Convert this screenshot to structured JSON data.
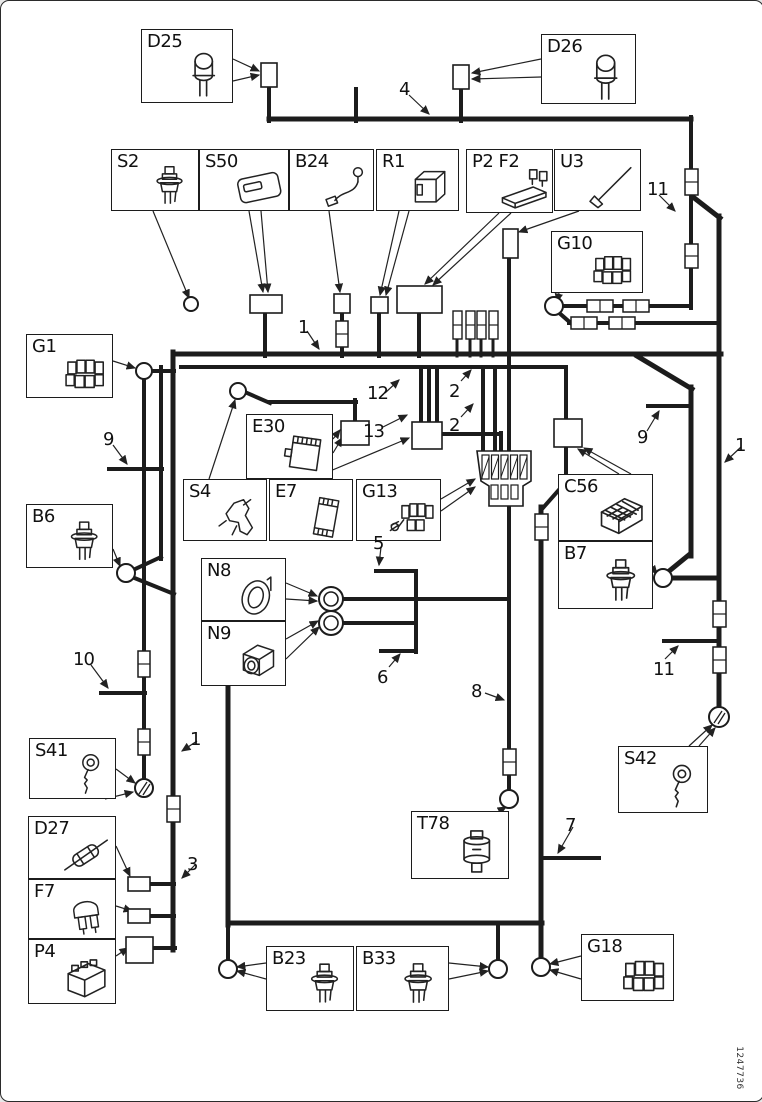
{
  "title": "Wiring harness diagram",
  "part_number": "1247736",
  "colors": {
    "line": "#1c1c1c",
    "background": "#ffffff"
  },
  "components": [
    {
      "id": "D25",
      "label": "D25",
      "icon": "bulb",
      "box": [
        140,
        28,
        92,
        74
      ]
    },
    {
      "id": "D26",
      "label": "D26",
      "icon": "bulb",
      "box": [
        540,
        33,
        95,
        70
      ]
    },
    {
      "id": "S2",
      "label": "S2",
      "icon": "sensor",
      "box": [
        110,
        148,
        88,
        62
      ]
    },
    {
      "id": "S50",
      "label": "S50",
      "icon": "module",
      "box": [
        198,
        148,
        90,
        62
      ]
    },
    {
      "id": "B24",
      "label": "B24",
      "icon": "cable",
      "box": [
        288,
        148,
        85,
        62
      ]
    },
    {
      "id": "R1",
      "label": "R1",
      "icon": "relay",
      "box": [
        375,
        148,
        83,
        62
      ]
    },
    {
      "id": "P2F2",
      "label": "P2 F2",
      "icon": "fusebox",
      "box": [
        465,
        148,
        87,
        64
      ]
    },
    {
      "id": "U3",
      "label": "U3",
      "icon": "antenna",
      "box": [
        553,
        148,
        87,
        62
      ]
    },
    {
      "id": "G10",
      "label": "G10",
      "icon": "connblock",
      "box": [
        550,
        230,
        92,
        62
      ]
    },
    {
      "id": "G1",
      "label": "G1",
      "icon": "connblock",
      "box": [
        25,
        333,
        87,
        64
      ]
    },
    {
      "id": "E30",
      "label": "E30",
      "icon": "ecu",
      "box": [
        245,
        413,
        87,
        65
      ]
    },
    {
      "id": "S4",
      "label": "S4",
      "icon": "switchmech",
      "box": [
        182,
        478,
        84,
        62
      ]
    },
    {
      "id": "E7",
      "label": "E7",
      "icon": "ecuplate",
      "box": [
        268,
        478,
        84,
        62
      ]
    },
    {
      "id": "G13",
      "label": "G13",
      "icon": "connwires",
      "box": [
        355,
        478,
        85,
        62
      ]
    },
    {
      "id": "C56",
      "label": "C56",
      "icon": "cage",
      "box": [
        557,
        473,
        95,
        67
      ]
    },
    {
      "id": "B7",
      "label": "B7",
      "icon": "sensor",
      "box": [
        557,
        540,
        95,
        68
      ]
    },
    {
      "id": "B6",
      "label": "B6",
      "icon": "sensor",
      "box": [
        25,
        503,
        87,
        64
      ]
    },
    {
      "id": "N8",
      "label": "N8",
      "icon": "ring",
      "box": [
        200,
        557,
        85,
        63
      ]
    },
    {
      "id": "N9",
      "label": "N9",
      "icon": "solenoid",
      "box": [
        200,
        620,
        85,
        65
      ]
    },
    {
      "id": "S41",
      "label": "S41",
      "icon": "key",
      "box": [
        28,
        737,
        87,
        61
      ]
    },
    {
      "id": "S42",
      "label": "S42",
      "icon": "key",
      "box": [
        617,
        745,
        90,
        67
      ]
    },
    {
      "id": "D27",
      "label": "D27",
      "icon": "inlinefuse",
      "box": [
        27,
        815,
        88,
        63
      ]
    },
    {
      "id": "F7",
      "label": "F7",
      "icon": "bladefuse",
      "box": [
        27,
        878,
        88,
        60
      ]
    },
    {
      "id": "P4",
      "label": "P4",
      "icon": "battery",
      "box": [
        27,
        938,
        88,
        65
      ]
    },
    {
      "id": "T78",
      "label": "T78",
      "icon": "cylsensor",
      "box": [
        410,
        810,
        98,
        68
      ]
    },
    {
      "id": "B23",
      "label": "B23",
      "icon": "sensor",
      "box": [
        265,
        945,
        88,
        65
      ]
    },
    {
      "id": "B33",
      "label": "B33",
      "icon": "sensor",
      "box": [
        355,
        945,
        93,
        65
      ]
    },
    {
      "id": "G18",
      "label": "G18",
      "icon": "connblock",
      "box": [
        580,
        933,
        93,
        67
      ]
    }
  ],
  "wire_labels": [
    {
      "text": "4",
      "x": 398,
      "y": 78
    },
    {
      "text": "11",
      "x": 646,
      "y": 178
    },
    {
      "text": "1",
      "x": 297,
      "y": 316
    },
    {
      "text": "12",
      "x": 366,
      "y": 382
    },
    {
      "text": "13",
      "x": 362,
      "y": 420
    },
    {
      "text": "2",
      "x": 448,
      "y": 380
    },
    {
      "text": "2",
      "x": 448,
      "y": 414
    },
    {
      "text": "9",
      "x": 102,
      "y": 428
    },
    {
      "text": "9",
      "x": 636,
      "y": 426
    },
    {
      "text": "1",
      "x": 734,
      "y": 434
    },
    {
      "text": "10",
      "x": 72,
      "y": 648
    },
    {
      "text": "1",
      "x": 189,
      "y": 728
    },
    {
      "text": "5",
      "x": 372,
      "y": 532
    },
    {
      "text": "6",
      "x": 376,
      "y": 666
    },
    {
      "text": "8",
      "x": 470,
      "y": 680
    },
    {
      "text": "11",
      "x": 652,
      "y": 658
    },
    {
      "text": "3",
      "x": 186,
      "y": 853
    },
    {
      "text": "7",
      "x": 564,
      "y": 814
    }
  ],
  "figure": {
    "wires": [
      [
        268,
        118,
        690,
        118,
        5
      ],
      [
        268,
        84,
        268,
        120,
        4
      ],
      [
        355,
        88,
        355,
        120,
        4
      ],
      [
        460,
        86,
        460,
        120,
        4
      ],
      [
        690,
        116,
        690,
        170,
        4
      ],
      [
        690,
        192,
        690,
        307,
        4
      ],
      [
        692,
        196,
        719,
        217,
        5
      ],
      [
        718,
        215,
        718,
        712,
        5
      ],
      [
        553,
        305,
        688,
        305,
        4
      ],
      [
        556,
        310,
        572,
        324,
        4
      ],
      [
        568,
        322,
        718,
        322,
        4
      ],
      [
        636,
        355,
        691,
        388,
        5
      ],
      [
        690,
        386,
        690,
        555,
        5
      ],
      [
        647,
        405,
        690,
        405,
        4
      ],
      [
        689,
        553,
        667,
        571,
        5
      ],
      [
        669,
        577,
        718,
        577,
        5
      ],
      [
        172,
        353,
        720,
        353,
        5
      ],
      [
        180,
        366,
        565,
        366,
        4
      ],
      [
        172,
        351,
        172,
        949,
        5
      ],
      [
        160,
        366,
        160,
        558,
        4
      ],
      [
        160,
        556,
        130,
        570,
        4
      ],
      [
        131,
        576,
        173,
        593,
        4
      ],
      [
        108,
        468,
        161,
        468,
        4
      ],
      [
        143,
        376,
        143,
        780,
        4
      ],
      [
        100,
        692,
        144,
        692,
        4
      ],
      [
        150,
        370,
        173,
        370,
        4
      ],
      [
        264,
        312,
        264,
        355,
        4
      ],
      [
        341,
        312,
        341,
        355,
        4
      ],
      [
        378,
        312,
        378,
        355,
        4
      ],
      [
        418,
        312,
        418,
        355,
        4
      ],
      [
        456,
        336,
        456,
        355,
        3
      ],
      [
        469,
        336,
        469,
        355,
        3
      ],
      [
        480,
        336,
        480,
        355,
        3
      ],
      [
        492,
        336,
        492,
        355,
        3
      ],
      [
        508,
        255,
        508,
        792,
        4
      ],
      [
        246,
        392,
        269,
        402,
        4
      ],
      [
        268,
        401,
        355,
        401,
        4
      ],
      [
        354,
        399,
        354,
        421,
        4
      ],
      [
        420,
        366,
        420,
        422,
        4
      ],
      [
        428,
        366,
        428,
        422,
        4
      ],
      [
        436,
        366,
        436,
        422,
        4
      ],
      [
        441,
        433,
        500,
        433,
        4
      ],
      [
        500,
        432,
        500,
        452,
        4
      ],
      [
        482,
        366,
        482,
        452,
        4
      ],
      [
        494,
        366,
        494,
        452,
        4
      ],
      [
        565,
        366,
        565,
        419,
        4
      ],
      [
        565,
        445,
        565,
        483,
        4
      ],
      [
        564,
        482,
        541,
        508,
        4
      ],
      [
        540,
        506,
        540,
        958,
        5
      ],
      [
        543,
        857,
        598,
        857,
        4
      ],
      [
        227,
        922,
        541,
        922,
        5
      ],
      [
        227,
        650,
        227,
        924,
        5
      ],
      [
        227,
        922,
        227,
        960,
        4
      ],
      [
        497,
        922,
        497,
        960,
        4
      ],
      [
        342,
        598,
        508,
        598,
        4
      ],
      [
        342,
        622,
        415,
        622,
        4
      ],
      [
        415,
        570,
        415,
        651,
        4
      ],
      [
        375,
        570,
        415,
        570,
        4
      ],
      [
        380,
        650,
        415,
        650,
        4
      ],
      [
        663,
        640,
        718,
        640,
        4
      ],
      [
        149,
        883,
        173,
        883,
        4
      ],
      [
        149,
        915,
        173,
        915,
        4
      ],
      [
        152,
        947,
        174,
        947,
        4
      ]
    ],
    "leaders": [
      [
        232,
        58,
        258,
        70
      ],
      [
        232,
        80,
        258,
        74
      ],
      [
        540,
        58,
        471,
        72
      ],
      [
        540,
        76,
        471,
        78
      ],
      [
        152,
        210,
        188,
        297
      ],
      [
        248,
        210,
        262,
        291
      ],
      [
        260,
        210,
        267,
        291
      ],
      [
        328,
        210,
        339,
        291
      ],
      [
        398,
        210,
        379,
        294
      ],
      [
        408,
        210,
        385,
        294
      ],
      [
        498,
        212,
        424,
        283
      ],
      [
        510,
        212,
        432,
        284
      ],
      [
        578,
        210,
        518,
        231
      ],
      [
        558,
        292,
        556,
        301
      ],
      [
        112,
        360,
        134,
        367
      ],
      [
        332,
        438,
        339,
        429
      ],
      [
        332,
        452,
        341,
        437
      ],
      [
        208,
        478,
        234,
        399
      ],
      [
        310,
        478,
        408,
        437
      ],
      [
        440,
        498,
        474,
        478
      ],
      [
        440,
        510,
        474,
        486
      ],
      [
        618,
        473,
        577,
        448
      ],
      [
        630,
        473,
        583,
        447
      ],
      [
        652,
        568,
        656,
        573
      ],
      [
        112,
        548,
        119,
        565
      ],
      [
        285,
        582,
        316,
        595
      ],
      [
        285,
        598,
        316,
        600
      ],
      [
        285,
        638,
        317,
        620
      ],
      [
        285,
        658,
        318,
        626
      ],
      [
        115,
        768,
        134,
        782
      ],
      [
        104,
        798,
        132,
        791
      ],
      [
        688,
        745,
        711,
        724
      ],
      [
        698,
        745,
        714,
        727
      ],
      [
        115,
        845,
        129,
        875
      ],
      [
        115,
        905,
        131,
        910
      ],
      [
        115,
        955,
        127,
        947
      ],
      [
        498,
        810,
        505,
        806
      ],
      [
        265,
        962,
        236,
        966
      ],
      [
        265,
        978,
        236,
        970
      ],
      [
        448,
        962,
        487,
        966
      ],
      [
        448,
        978,
        487,
        970
      ],
      [
        580,
        955,
        549,
        963
      ],
      [
        580,
        978,
        549,
        969
      ],
      [
        408,
        94,
        428,
        113
      ],
      [
        658,
        194,
        674,
        210
      ],
      [
        306,
        330,
        318,
        348
      ],
      [
        384,
        392,
        398,
        379
      ],
      [
        382,
        426,
        406,
        414
      ],
      [
        460,
        380,
        470,
        369
      ],
      [
        460,
        416,
        472,
        403
      ],
      [
        112,
        444,
        126,
        463
      ],
      [
        646,
        430,
        658,
        410
      ],
      [
        740,
        446,
        724,
        461
      ],
      [
        90,
        664,
        107,
        687
      ],
      [
        196,
        740,
        181,
        750
      ],
      [
        380,
        546,
        378,
        564
      ],
      [
        388,
        666,
        399,
        653
      ],
      [
        484,
        692,
        503,
        699
      ],
      [
        664,
        658,
        677,
        645
      ],
      [
        194,
        864,
        181,
        877
      ],
      [
        572,
        826,
        557,
        852
      ]
    ],
    "inline_connectors": [
      [
        684,
        168,
        13,
        26
      ],
      [
        684,
        243,
        13,
        24
      ],
      [
        586,
        299,
        26,
        12
      ],
      [
        622,
        299,
        26,
        12
      ],
      [
        570,
        316,
        26,
        12
      ],
      [
        608,
        316,
        26,
        12
      ],
      [
        712,
        600,
        13,
        26
      ],
      [
        712,
        646,
        13,
        26
      ],
      [
        137,
        650,
        12,
        26
      ],
      [
        137,
        728,
        12,
        26
      ],
      [
        166,
        795,
        13,
        26
      ],
      [
        335,
        320,
        12,
        26
      ],
      [
        502,
        748,
        13,
        26
      ],
      [
        534,
        513,
        13,
        26
      ]
    ],
    "terminals": [
      [
        260,
        62,
        16,
        24
      ],
      [
        452,
        64,
        16,
        24
      ],
      [
        249,
        294,
        32,
        18
      ],
      [
        333,
        293,
        16,
        19
      ],
      [
        370,
        296,
        17,
        16
      ],
      [
        396,
        285,
        45,
        27
      ],
      [
        502,
        228,
        15,
        29
      ],
      [
        340,
        420,
        28,
        24
      ],
      [
        411,
        421,
        30,
        27
      ],
      [
        553,
        418,
        28,
        28
      ],
      [
        127,
        876,
        22,
        14
      ],
      [
        127,
        908,
        22,
        14
      ],
      [
        125,
        936,
        27,
        26
      ]
    ],
    "pins": [
      [
        452,
        310,
        9,
        28
      ],
      [
        465,
        310,
        9,
        28
      ],
      [
        476,
        310,
        9,
        28
      ],
      [
        488,
        310,
        9,
        28
      ]
    ],
    "circles": [
      [
        190,
        303,
        7,
        "plain"
      ],
      [
        553,
        305,
        9,
        "plain"
      ],
      [
        143,
        370,
        8,
        "plain"
      ],
      [
        237,
        390,
        8,
        "plain"
      ],
      [
        125,
        572,
        9,
        "plain"
      ],
      [
        662,
        577,
        9,
        "plain"
      ],
      [
        330,
        598,
        12,
        "double"
      ],
      [
        330,
        622,
        12,
        "double"
      ],
      [
        143,
        787,
        9,
        "hatch"
      ],
      [
        718,
        716,
        10,
        "hatch"
      ],
      [
        508,
        798,
        9,
        "plain"
      ],
      [
        227,
        968,
        9,
        "plain"
      ],
      [
        497,
        968,
        9,
        "plain"
      ],
      [
        540,
        966,
        9,
        "plain"
      ]
    ],
    "big_connector": {
      "x": 476,
      "y": 450,
      "w": 54,
      "h": 55
    }
  }
}
